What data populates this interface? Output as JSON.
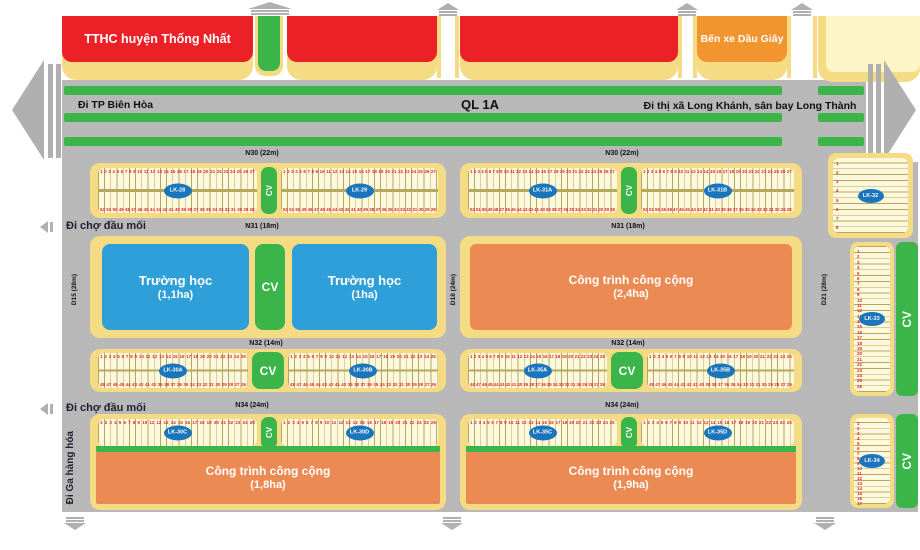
{
  "colors": {
    "road_gray": "#b8b8b8",
    "green_cv": "#3bb44a",
    "red_block": "#ec2127",
    "orange_bus_station": "#f3952f",
    "orange_public": "#ec8a54",
    "blue_school": "#2e9fd8",
    "lot_label_blue": "#1b75bc",
    "slab_yellow": "#f6db85",
    "lot_cream": "#fcf8dd",
    "lot_number_red": "#e4262a"
  },
  "top_row": {
    "tthc_label": "TTHC huyện Thống Nhất",
    "bus_station_label": "Bến xe Dầu Giây"
  },
  "highway": {
    "name": "QL 1A",
    "west": "Đi TP Biên Hòa",
    "east": "Đi thị xã Long Khánh, sân bay Long Thành"
  },
  "roads": {
    "n30": "N30 (22m)",
    "n31": "N31 (18m)",
    "n32": "N32 (14m)",
    "n34": "N34 (24m)",
    "d15": "D15 (28m)",
    "d18": "D18 (24m)",
    "d21": "D21 (28m)",
    "to_market": "Đi chợ đầu mối",
    "to_freight_station": "Đi Ga hàng hóa"
  },
  "cv": "CV",
  "facilities": {
    "school1": {
      "name": "Trường học",
      "area": "(1,1ha)"
    },
    "school2": {
      "name": "Trường học",
      "area": "(1ha)"
    },
    "public1": {
      "name": "Công trình công cộng",
      "area": "(2,4ha)"
    },
    "public2": {
      "name": "Công trình công cộng",
      "area": "(1,8ha)"
    },
    "public3": {
      "name": "Công trình công cộng",
      "area": "(1,9ha)"
    }
  },
  "lots": {
    "lk28": {
      "label": "LK-28",
      "top": {
        "from": 1,
        "to": 27
      },
      "bottom": {
        "from": 52,
        "to": 28
      }
    },
    "lk29": {
      "label": "LK-29",
      "top": {
        "from": 1,
        "to": 27
      },
      "bottom": {
        "from": 52,
        "to": 28
      }
    },
    "lk31a": {
      "label": "LK-31A",
      "top": {
        "from": 1,
        "to": 27
      },
      "bottom": {
        "from": 52,
        "to": 28
      }
    },
    "lk31b": {
      "label": "LK-31B",
      "top": {
        "from": 1,
        "to": 27
      },
      "bottom": {
        "from": 52,
        "to": 28
      }
    },
    "lk30a": {
      "label": "LK-30A",
      "top": {
        "from": 1,
        "to": 25
      },
      "bottom": {
        "from": 48,
        "to": 26
      }
    },
    "lk30b": {
      "label": "LK-30B",
      "top": {
        "from": 1,
        "to": 25
      },
      "bottom": {
        "from": 48,
        "to": 26
      }
    },
    "lk35a": {
      "label": "LK-35A",
      "top": {
        "from": 1,
        "to": 25
      },
      "bottom": {
        "from": 48,
        "to": 26
      }
    },
    "lk35b": {
      "label": "LK-35B",
      "top": {
        "from": 1,
        "to": 25
      },
      "bottom": {
        "from": 48,
        "to": 26
      }
    },
    "lk30c": {
      "label": "LK-30C",
      "top": {
        "from": 1,
        "to": 25
      }
    },
    "lk30d": {
      "label": "LK-30D",
      "top": {
        "from": 1,
        "to": 25
      }
    },
    "lk35c": {
      "label": "LK-35C",
      "top": {
        "from": 1,
        "to": 25
      }
    },
    "lk35d": {
      "label": "LK-35D",
      "top": {
        "from": 1,
        "to": 25
      }
    },
    "lk32": {
      "label": "LK-32",
      "rows": {
        "from": 1,
        "to": 8
      }
    },
    "lk33": {
      "label": "LK-33",
      "rows": {
        "from": 1,
        "to": 26
      }
    },
    "lk34": {
      "label": "LK-34",
      "rows": {
        "from": 1,
        "to": 17
      }
    }
  }
}
